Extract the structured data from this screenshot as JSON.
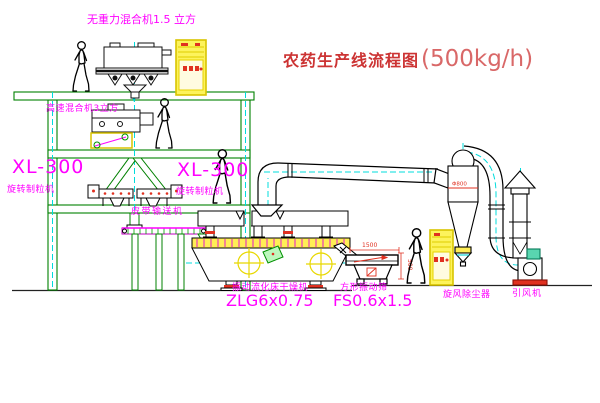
{
  "title": {
    "text": "农药生产线流程图",
    "capacity": "(500kg/h)"
  },
  "labels": {
    "gravity_mixer": "无重力混合机1.5 立方",
    "high_speed_mixer": "高速混合机3立方",
    "granulator_left_model": "XL-300",
    "granulator_left": "旋转制粒机",
    "granulator_right_model": "XL-300",
    "granulator_right": "旋转制粒机",
    "belt_conveyor": "皮带输送机",
    "fluid_bed_dryer": "振动流化床干燥机",
    "fluid_bed_dryer_model": "ZLG6x0.75",
    "square_sieve": "方形振动筛",
    "square_sieve_model": "FS0.6x1.5",
    "cyclone": "旋风除尘器",
    "induced_draft_fan": "引风机"
  },
  "dimensions": {
    "sieve_length": "1500",
    "sieve_height": "500",
    "cyclone_dia": "Φ800"
  },
  "colors": {
    "structure_green": "#008000",
    "centerline_cyan": "#00dcdc",
    "label_magenta": "#ff00ff",
    "title_red": "#cc3333",
    "capacity_red": "#d96868",
    "highlight_yellow": "#f0dc00",
    "detail_red": "#e03020",
    "equipment_black": "#000000",
    "background": "#ffffff"
  }
}
